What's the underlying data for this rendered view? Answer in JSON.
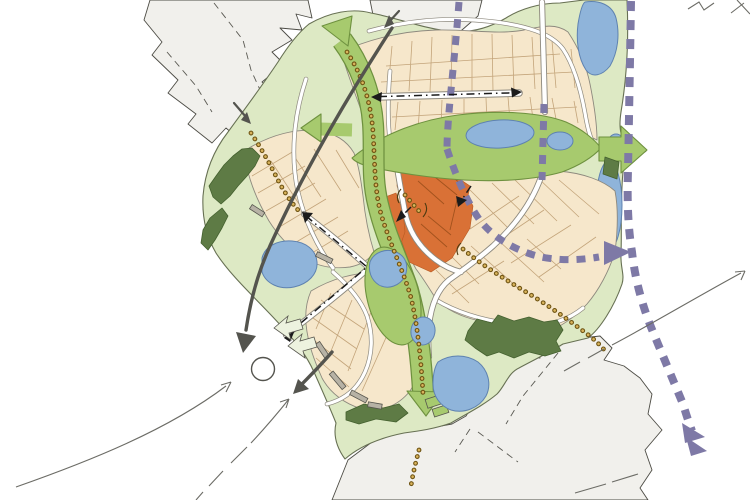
{
  "map": {
    "kind": "hand-drawn urban masterplan sketch, no text labels",
    "features": [
      "existing-built-area",
      "site-open-space",
      "development-parcels",
      "town-centre-parcels",
      "green-corridor-with-arrows",
      "woodland-belts",
      "ponds",
      "primary-streets",
      "main-street-centerline-arrows",
      "purple-dashed-route",
      "ochre-dotted-footpaths",
      "roundabout",
      "vehicular-access-arrows",
      "pedestrian-connector-arrows",
      "existing-road-sketch-lines"
    ]
  },
  "colors": {
    "background": "#ffffff",
    "existing_area": "#f1f0ec",
    "existing_outline": "#4c4b44",
    "open_space": "#dde9c4",
    "open_space_outline": "#677053",
    "parcels": "#f6e7cb",
    "parcel_line": "#c3a47a",
    "parcel_outline": "#8d897e",
    "town_centre": "#d97136",
    "town_centre_line": "#a2521d",
    "green_corridor": "#a7ca6e",
    "green_corridor_edge": "#6e913f",
    "woodland": "#5e7b45",
    "woodland_edge": "#44602f",
    "water": "#8fb4da",
    "water_edge": "#5e82b0",
    "road_fill": "#ffffff",
    "road_edge": "#8d897e",
    "route_purple": "#7e79a6",
    "trail_dot": "#d8b35c",
    "trail_dot_edge": "#6f5413",
    "building": "#b7b2a5",
    "building_edge": "#56554d",
    "arrow_dark": "#54544e",
    "centerline": "#1b1b1b",
    "connector_arrow_fill": "#edf2df",
    "sketch_line": "#6c6c66"
  }
}
